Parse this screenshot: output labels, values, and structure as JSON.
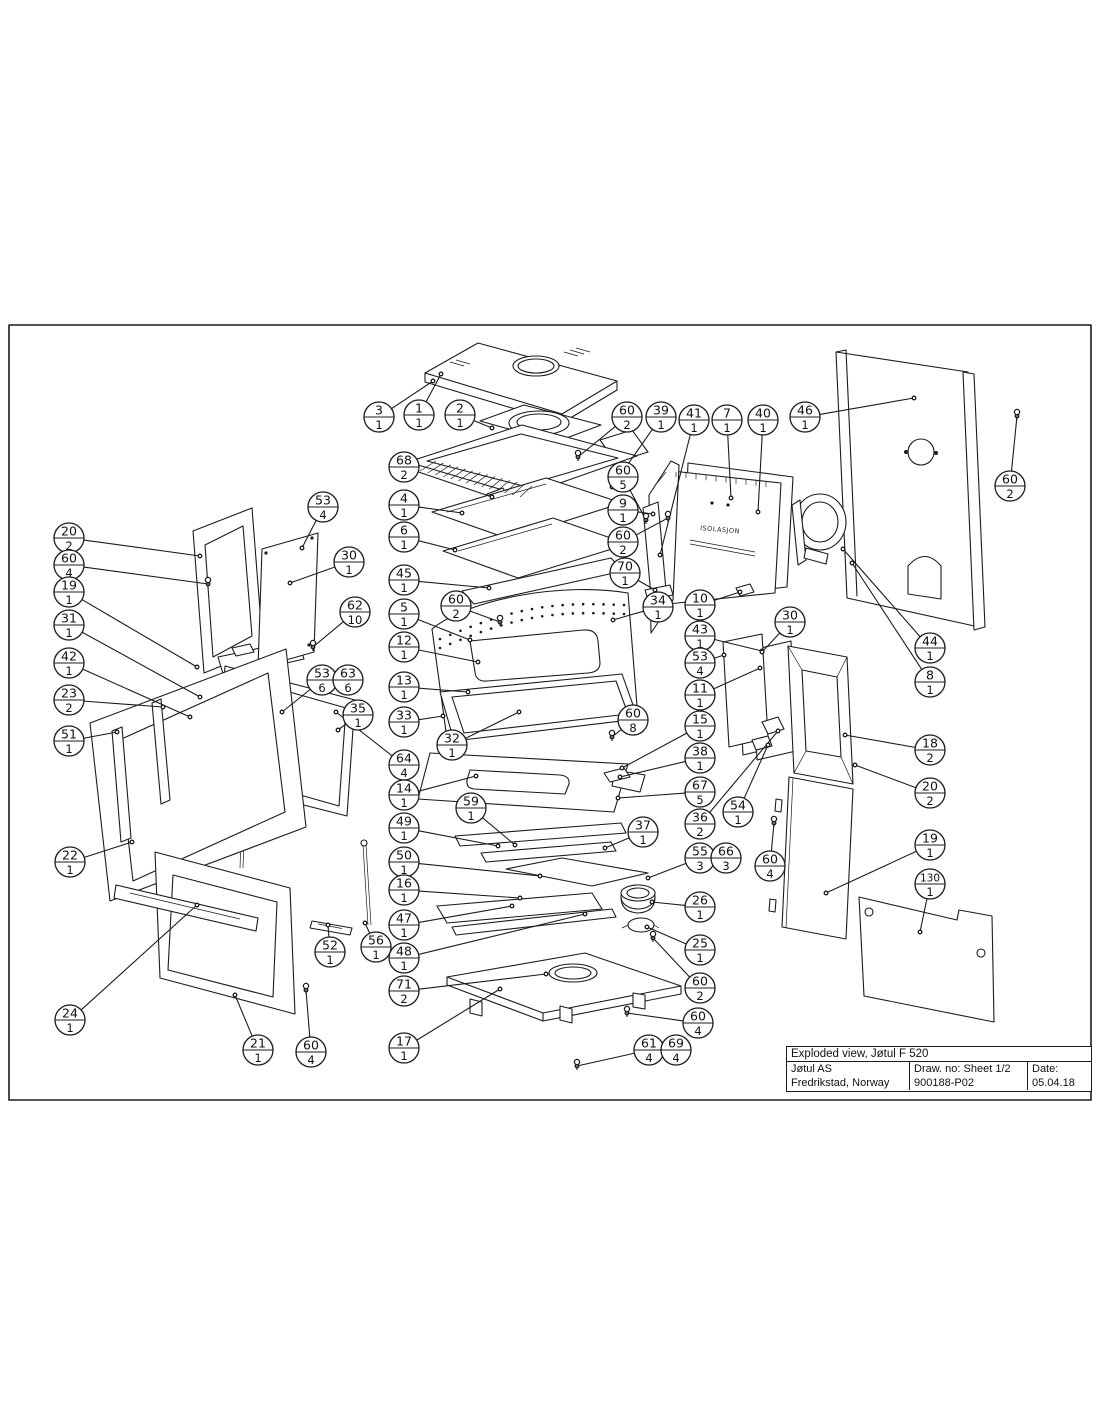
{
  "page": {
    "background": "#ffffff",
    "ink_color": "#1c1c1c"
  },
  "title_block": {
    "title": "Exploded view, Jøtul F 520",
    "company": "Jøtul AS",
    "address": "Fredrikstad, Norway",
    "draw_no": "Draw. no: Sheet 1/2",
    "drawing_number": "900188-P02",
    "date_label": "Date:",
    "date": "05.04.18"
  },
  "diagram": {
    "frame": {
      "x": 9,
      "y": 325,
      "w": 1082,
      "h": 775
    },
    "insulation_label": "ISOLASJON",
    "callouts": [
      {
        "part": "3",
        "qty": "1",
        "x": 379,
        "y": 417,
        "tx": 433,
        "ty": 381
      },
      {
        "part": "1",
        "qty": "1",
        "x": 419,
        "y": 415,
        "tx": 441,
        "ty": 374
      },
      {
        "part": "2",
        "qty": "1",
        "x": 460,
        "y": 415,
        "tx": 492,
        "ty": 428
      },
      {
        "part": "60",
        "qty": "2",
        "x": 627,
        "y": 417,
        "tx": 578,
        "ty": 457
      },
      {
        "part": "39",
        "qty": "1",
        "x": 661,
        "y": 417,
        "tx": 612,
        "ty": 487
      },
      {
        "part": "41",
        "qty": "1",
        "x": 694,
        "y": 420,
        "tx": 660,
        "ty": 555
      },
      {
        "part": "7",
        "qty": "1",
        "x": 727,
        "y": 420,
        "tx": 731,
        "ty": 498
      },
      {
        "part": "40",
        "qty": "1",
        "x": 763,
        "y": 420,
        "tx": 758,
        "ty": 512
      },
      {
        "part": "46",
        "qty": "1",
        "x": 805,
        "y": 417,
        "tx": 914,
        "ty": 398
      },
      {
        "part": "60",
        "qty": "2",
        "x": 1010,
        "y": 486,
        "tx": 1017,
        "ty": 416
      },
      {
        "part": "68",
        "qty": "2",
        "x": 404,
        "y": 467,
        "tx": 492,
        "ty": 497
      },
      {
        "part": "4",
        "qty": "1",
        "x": 404,
        "y": 505,
        "tx": 462,
        "ty": 513
      },
      {
        "part": "6",
        "qty": "1",
        "x": 404,
        "y": 537,
        "tx": 455,
        "ty": 550
      },
      {
        "part": "45",
        "qty": "1",
        "x": 404,
        "y": 580,
        "tx": 489,
        "ty": 588
      },
      {
        "part": "60",
        "qty": "2",
        "x": 456,
        "y": 606,
        "tx": 500,
        "ty": 622
      },
      {
        "part": "5",
        "qty": "1",
        "x": 404,
        "y": 614,
        "tx": 470,
        "ty": 640
      },
      {
        "part": "12",
        "qty": "1",
        "x": 404,
        "y": 647,
        "tx": 478,
        "ty": 662
      },
      {
        "part": "13",
        "qty": "1",
        "x": 404,
        "y": 687,
        "tx": 468,
        "ty": 692
      },
      {
        "part": "33",
        "qty": "1",
        "x": 404,
        "y": 722,
        "tx": 443,
        "ty": 716
      },
      {
        "part": "32",
        "qty": "1",
        "x": 452,
        "y": 745,
        "tx": 519,
        "ty": 712
      },
      {
        "part": "64",
        "qty": "4",
        "x": 404,
        "y": 765,
        "tx": 336,
        "ty": 712
      },
      {
        "part": "14",
        "qty": "1",
        "x": 404,
        "y": 795,
        "tx": 476,
        "ty": 776
      },
      {
        "part": "59",
        "qty": "1",
        "x": 471,
        "y": 808,
        "tx": 515,
        "ty": 845
      },
      {
        "part": "49",
        "qty": "1",
        "x": 404,
        "y": 828,
        "tx": 498,
        "ty": 846
      },
      {
        "part": "50",
        "qty": "1",
        "x": 404,
        "y": 862,
        "tx": 540,
        "ty": 876
      },
      {
        "part": "16",
        "qty": "1",
        "x": 404,
        "y": 890,
        "tx": 520,
        "ty": 898
      },
      {
        "part": "47",
        "qty": "1",
        "x": 404,
        "y": 925,
        "tx": 512,
        "ty": 906
      },
      {
        "part": "48",
        "qty": "1",
        "x": 404,
        "y": 958,
        "tx": 585,
        "ty": 914
      },
      {
        "part": "71",
        "qty": "2",
        "x": 404,
        "y": 991,
        "tx": 546,
        "ty": 974
      },
      {
        "part": "17",
        "qty": "1",
        "x": 404,
        "y": 1048,
        "tx": 500,
        "ty": 989
      },
      {
        "part": "60",
        "qty": "5",
        "x": 623,
        "y": 477,
        "tx": 646,
        "ty": 520
      },
      {
        "part": "9",
        "qty": "1",
        "x": 623,
        "y": 510,
        "tx": 653,
        "ty": 514
      },
      {
        "part": "60",
        "qty": "2",
        "x": 623,
        "y": 542,
        "tx": 668,
        "ty": 518
      },
      {
        "part": "70",
        "qty": "1",
        "x": 625,
        "y": 573,
        "tx": 655,
        "ty": 590
      },
      {
        "part": "34",
        "qty": "1",
        "x": 658,
        "y": 607,
        "tx": 613,
        "ty": 620
      },
      {
        "part": "10",
        "qty": "1",
        "x": 700,
        "y": 605,
        "tx": 740,
        "ty": 592
      },
      {
        "part": "43",
        "qty": "1",
        "x": 700,
        "y": 636,
        "tx": 762,
        "ty": 651
      },
      {
        "part": "53",
        "qty": "4",
        "x": 700,
        "y": 663,
        "tx": 724,
        "ty": 655
      },
      {
        "part": "11",
        "qty": "1",
        "x": 700,
        "y": 695,
        "tx": 760,
        "ty": 668
      },
      {
        "part": "30",
        "qty": "1",
        "x": 790,
        "y": 622,
        "tx": 762,
        "ty": 652
      },
      {
        "part": "60",
        "qty": "8",
        "x": 633,
        "y": 720,
        "tx": 612,
        "ty": 737
      },
      {
        "part": "15",
        "qty": "1",
        "x": 700,
        "y": 726,
        "tx": 622,
        "ty": 768
      },
      {
        "part": "38",
        "qty": "1",
        "x": 700,
        "y": 758,
        "tx": 620,
        "ty": 777
      },
      {
        "part": "67",
        "qty": "5",
        "x": 700,
        "y": 792,
        "tx": 618,
        "ty": 798
      },
      {
        "part": "36",
        "qty": "2",
        "x": 700,
        "y": 824,
        "tx": 778,
        "ty": 731
      },
      {
        "part": "54",
        "qty": "1",
        "x": 738,
        "y": 812,
        "tx": 768,
        "ty": 745
      },
      {
        "part": "37",
        "qty": "1",
        "x": 643,
        "y": 832,
        "tx": 605,
        "ty": 848
      },
      {
        "part": "55",
        "qty": "3",
        "x": 700,
        "y": 858,
        "tx": 648,
        "ty": 878
      },
      {
        "part": "66",
        "qty": "3",
        "x": 726,
        "y": 858
      },
      {
        "part": "60",
        "qty": "4",
        "x": 770,
        "y": 866,
        "tx": 774,
        "ty": 823
      },
      {
        "part": "26",
        "qty": "1",
        "x": 700,
        "y": 907,
        "tx": 652,
        "ty": 902
      },
      {
        "part": "25",
        "qty": "1",
        "x": 700,
        "y": 950,
        "tx": 647,
        "ty": 927
      },
      {
        "part": "60",
        "qty": "2",
        "x": 700,
        "y": 988,
        "tx": 653,
        "ty": 938
      },
      {
        "part": "44",
        "qty": "1",
        "x": 930,
        "y": 648,
        "tx": 843,
        "ty": 549
      },
      {
        "part": "8",
        "qty": "1",
        "x": 930,
        "y": 682,
        "tx": 852,
        "ty": 563
      },
      {
        "part": "18",
        "qty": "2",
        "x": 930,
        "y": 750,
        "tx": 845,
        "ty": 735
      },
      {
        "part": "20",
        "qty": "2",
        "x": 930,
        "y": 793,
        "tx": 855,
        "ty": 765
      },
      {
        "part": "19",
        "qty": "1",
        "x": 930,
        "y": 845,
        "tx": 826,
        "ty": 893
      },
      {
        "part": "130",
        "qty": "1",
        "x": 930,
        "y": 884,
        "tx": 920,
        "ty": 932
      },
      {
        "part": "20",
        "qty": "2",
        "x": 69,
        "y": 538,
        "tx": 200,
        "ty": 556
      },
      {
        "part": "60",
        "qty": "4",
        "x": 69,
        "y": 565,
        "tx": 208,
        "ty": 584
      },
      {
        "part": "19",
        "qty": "1",
        "x": 69,
        "y": 592,
        "tx": 197,
        "ty": 667
      },
      {
        "part": "31",
        "qty": "1",
        "x": 69,
        "y": 625,
        "tx": 200,
        "ty": 697
      },
      {
        "part": "42",
        "qty": "1",
        "x": 69,
        "y": 663,
        "tx": 190,
        "ty": 717
      },
      {
        "part": "23",
        "qty": "2",
        "x": 69,
        "y": 700,
        "tx": 163,
        "ty": 707
      },
      {
        "part": "51",
        "qty": "1",
        "x": 69,
        "y": 741,
        "tx": 117,
        "ty": 732
      },
      {
        "part": "22",
        "qty": "1",
        "x": 70,
        "y": 862,
        "tx": 132,
        "ty": 842
      },
      {
        "part": "24",
        "qty": "1",
        "x": 70,
        "y": 1020,
        "tx": 197,
        "ty": 905
      },
      {
        "part": "21",
        "qty": "1",
        "x": 258,
        "y": 1050,
        "tx": 235,
        "ty": 995
      },
      {
        "part": "60",
        "qty": "4",
        "x": 311,
        "y": 1052,
        "tx": 306,
        "ty": 990
      },
      {
        "part": "52",
        "qty": "1",
        "x": 330,
        "y": 952,
        "tx": 328,
        "ty": 925
      },
      {
        "part": "56",
        "qty": "1",
        "x": 376,
        "y": 947,
        "tx": 365,
        "ty": 923
      },
      {
        "part": "53",
        "qty": "4",
        "x": 323,
        "y": 507,
        "tx": 302,
        "ty": 548
      },
      {
        "part": "30",
        "qty": "1",
        "x": 349,
        "y": 562,
        "tx": 290,
        "ty": 583
      },
      {
        "part": "62",
        "qty": "10",
        "x": 355,
        "y": 612,
        "tx": 313,
        "ty": 647
      },
      {
        "part": "53",
        "qty": "6",
        "x": 322,
        "y": 680,
        "tx": 282,
        "ty": 712
      },
      {
        "part": "63",
        "qty": "6",
        "x": 348,
        "y": 680
      },
      {
        "part": "35",
        "qty": "1",
        "x": 358,
        "y": 715,
        "tx": 338,
        "ty": 730
      },
      {
        "part": "60",
        "qty": "4",
        "x": 698,
        "y": 1023,
        "tx": 627,
        "ty": 1013
      },
      {
        "part": "61",
        "qty": "4",
        "x": 649,
        "y": 1050,
        "tx": 577,
        "ty": 1066
      },
      {
        "part": "69",
        "qty": "4",
        "x": 676,
        "y": 1050
      }
    ]
  }
}
